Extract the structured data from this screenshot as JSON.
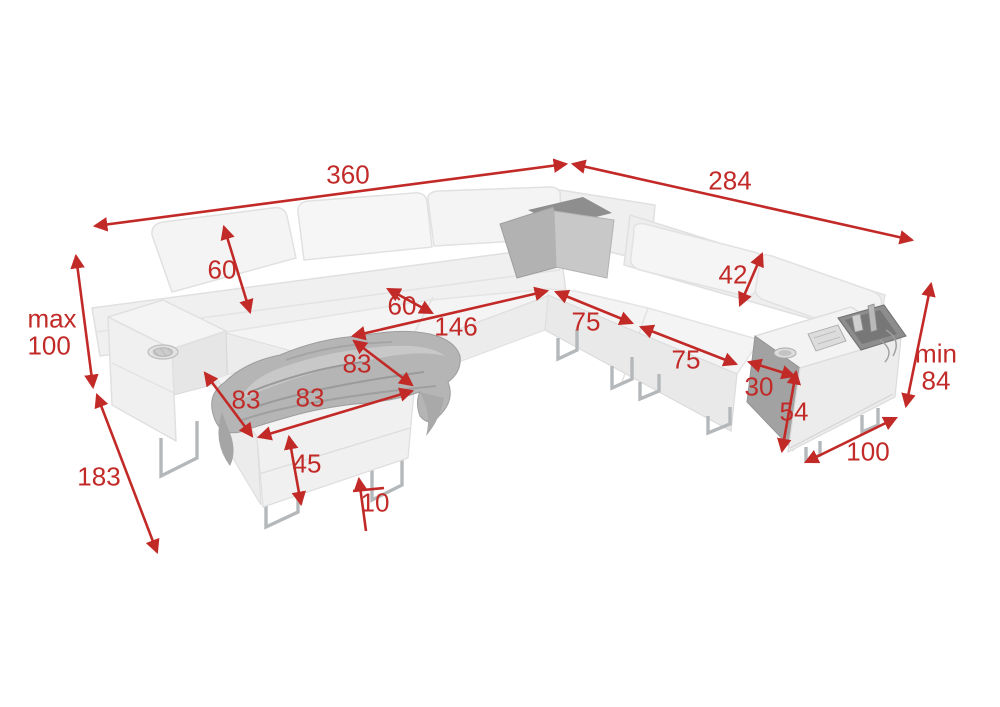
{
  "accent_color": "#c22a28",
  "figure": {
    "kind": "sofa-dimension-diagram"
  },
  "labels": {
    "total_width_left": "360",
    "total_width_right": "284",
    "backrest_height": "60",
    "seat_depth": "60",
    "bed_length": "146",
    "seat_width_a": "75",
    "seat_width_b": "75",
    "headrest_height": "42",
    "armrest_top_width": "30",
    "armrest_front_height": "54",
    "min_prefix": "min",
    "min_height": "84",
    "max_prefix": "max",
    "max_height": "100",
    "depth_right": "100",
    "depth_left": "183",
    "ottoman_diagonal": "83",
    "ottoman_side": "83",
    "ottoman_width": "83",
    "ottoman_height": "45",
    "leg_height": "10"
  }
}
